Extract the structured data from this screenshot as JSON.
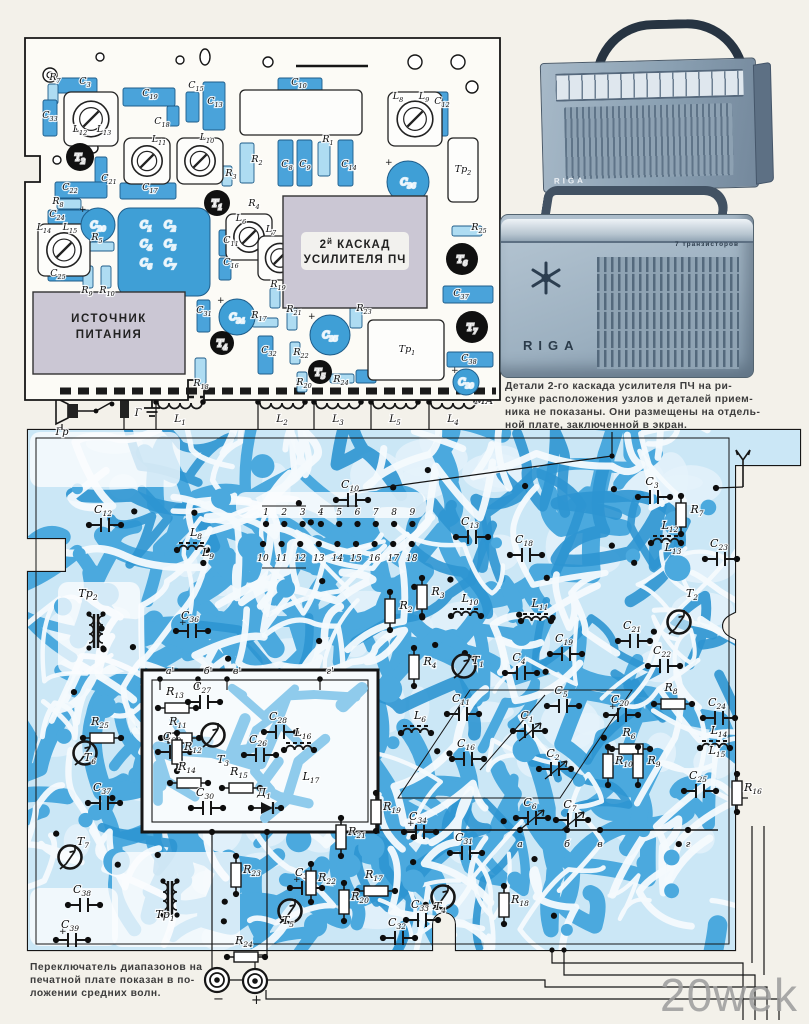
{
  "page": {
    "bg": "#f3f1ea",
    "watermark": "20wek"
  },
  "colors": {
    "trace_mid": "#4ba9de",
    "trace_deep": "#2e95d2",
    "trace_light": "#cbe7f6",
    "channel": "#f4fafd",
    "part_blue": "#4aa3da",
    "part_blue_deep": "#3f9fd6",
    "part_light": "#aedcf2",
    "shield_gray": "#cbc7d4",
    "ink": "#161616"
  },
  "note_right": {
    "lines": [
      "Детали 2-го каскада усилителя ПЧ на ри-",
      "сунке расположения узлов и деталей прием-",
      "ника не показаны. Они размещены на отдель-",
      "ной плате, заключенной в экран."
    ]
  },
  "caption_bottom": {
    "lines": [
      "Переключатель диапазонов на",
      "печатной плате показан в по-",
      "ложении средних волн."
    ]
  },
  "photos": {
    "radio1": {
      "brand": "RIGA"
    },
    "radio2": {
      "brand": "RIGA",
      "subtitle": "7 транзисторов"
    }
  },
  "strip": {
    "speaker": "Гр",
    "jack": "Г",
    "ma": "МА",
    "coils": [
      {
        "l": "L1",
        "x": 180
      },
      {
        "l": "L2",
        "x": 282
      },
      {
        "l": "L3",
        "x": 338
      },
      {
        "l": "L5",
        "x": 395
      },
      {
        "l": "L4",
        "x": 453
      }
    ]
  },
  "connectors": [
    {
      "sign": "−",
      "x": 217,
      "y": 980
    },
    {
      "sign": "+",
      "x": 255,
      "y": 981
    }
  ],
  "comp_board": {
    "shield_if": {
      "pre": "2",
      "sup": "й",
      "post": " КАСКАД",
      "line2": "УСИЛИТЕЛЯ ПЧ",
      "x": 283,
      "y": 196,
      "w": 144,
      "h": 112
    },
    "shield_ps": {
      "line1": "ИСТОЧНИК",
      "line2": "ПИТАНИЯ",
      "x": 33,
      "y": 292,
      "w": 152,
      "h": 82
    },
    "block_caps": {
      "labels": [
        "C1",
        "C2",
        "C4",
        "C5",
        "C6",
        "C7"
      ],
      "x": 118,
      "y": 208,
      "w": 92,
      "h": 88
    },
    "parts": [
      {
        "k": "b",
        "x": 57,
        "y": 78,
        "w": 40,
        "h": 15
      },
      {
        "k": "lb",
        "x": 48,
        "y": 84,
        "w": 10,
        "h": 20
      },
      {
        "k": "b",
        "x": 43,
        "y": 100,
        "w": 14,
        "h": 36
      },
      {
        "k": "b",
        "x": 123,
        "y": 88,
        "w": 52,
        "h": 18
      },
      {
        "k": "b",
        "x": 186,
        "y": 92,
        "w": 13,
        "h": 30
      },
      {
        "k": "b",
        "x": 167,
        "y": 106,
        "w": 12,
        "h": 20
      },
      {
        "k": "b",
        "x": 203,
        "y": 82,
        "w": 22,
        "h": 48
      },
      {
        "k": "b",
        "x": 95,
        "y": 157,
        "w": 12,
        "h": 26
      },
      {
        "k": "b",
        "x": 55,
        "y": 182,
        "w": 52,
        "h": 16
      },
      {
        "k": "lb",
        "x": 57,
        "y": 199,
        "w": 24,
        "h": 10
      },
      {
        "k": "b",
        "x": 48,
        "y": 210,
        "w": 42,
        "h": 14
      },
      {
        "k": "b",
        "x": 48,
        "y": 268,
        "w": 40,
        "h": 13
      },
      {
        "k": "lb",
        "x": 88,
        "y": 242,
        "w": 26,
        "h": 9
      },
      {
        "k": "lb",
        "x": 83,
        "y": 266,
        "w": 10,
        "h": 22
      },
      {
        "k": "lb",
        "x": 101,
        "y": 266,
        "w": 10,
        "h": 22
      },
      {
        "k": "b",
        "x": 120,
        "y": 183,
        "w": 56,
        "h": 16
      },
      {
        "k": "b",
        "x": 197,
        "y": 300,
        "w": 13,
        "h": 32
      },
      {
        "k": "lb",
        "x": 195,
        "y": 358,
        "w": 11,
        "h": 26
      },
      {
        "k": "b",
        "x": 219,
        "y": 230,
        "w": 12,
        "h": 26
      },
      {
        "k": "b",
        "x": 219,
        "y": 258,
        "w": 12,
        "h": 22
      },
      {
        "k": "lb",
        "x": 222,
        "y": 166,
        "w": 10,
        "h": 20
      },
      {
        "k": "lb",
        "x": 240,
        "y": 143,
        "w": 14,
        "h": 40
      },
      {
        "k": "b",
        "x": 278,
        "y": 78,
        "w": 44,
        "h": 16
      },
      {
        "k": "wr",
        "x": 240,
        "y": 90,
        "w": 122,
        "h": 45
      },
      {
        "k": "b",
        "x": 278,
        "y": 140,
        "w": 15,
        "h": 46
      },
      {
        "k": "b",
        "x": 297,
        "y": 140,
        "w": 15,
        "h": 46
      },
      {
        "k": "lb",
        "x": 318,
        "y": 142,
        "w": 12,
        "h": 34
      },
      {
        "k": "b",
        "x": 338,
        "y": 140,
        "w": 15,
        "h": 46
      },
      {
        "k": "b",
        "x": 432,
        "y": 92,
        "w": 16,
        "h": 44
      },
      {
        "k": "wr",
        "x": 448,
        "y": 138,
        "w": 30,
        "h": 64
      },
      {
        "k": "lb",
        "x": 452,
        "y": 226,
        "w": 30,
        "h": 10
      },
      {
        "k": "b",
        "x": 443,
        "y": 286,
        "w": 50,
        "h": 17
      },
      {
        "k": "b",
        "x": 447,
        "y": 352,
        "w": 46,
        "h": 15
      },
      {
        "k": "lb",
        "x": 350,
        "y": 302,
        "w": 12,
        "h": 26
      },
      {
        "k": "lb",
        "x": 287,
        "y": 308,
        "w": 10,
        "h": 22
      },
      {
        "k": "lb",
        "x": 252,
        "y": 318,
        "w": 26,
        "h": 9
      },
      {
        "k": "b",
        "x": 258,
        "y": 336,
        "w": 15,
        "h": 38
      },
      {
        "k": "lb",
        "x": 290,
        "y": 342,
        "w": 10,
        "h": 22
      },
      {
        "k": "lb",
        "x": 297,
        "y": 372,
        "w": 10,
        "h": 20
      },
      {
        "k": "lb",
        "x": 330,
        "y": 374,
        "w": 24,
        "h": 9
      },
      {
        "k": "b",
        "x": 356,
        "y": 370,
        "w": 20,
        "h": 13
      },
      {
        "k": "wr",
        "x": 368,
        "y": 320,
        "w": 76,
        "h": 60
      },
      {
        "k": "lb",
        "x": 270,
        "y": 288,
        "w": 10,
        "h": 20
      }
    ],
    "trimmers": [
      {
        "x": 64,
        "y": 92,
        "s": 54
      },
      {
        "x": 124,
        "y": 138,
        "s": 46
      },
      {
        "x": 177,
        "y": 138,
        "s": 46
      },
      {
        "x": 38,
        "y": 224,
        "s": 52
      },
      {
        "x": 226,
        "y": 214,
        "s": 46
      },
      {
        "x": 258,
        "y": 236,
        "s": 44
      },
      {
        "x": 388,
        "y": 92,
        "s": 54
      }
    ],
    "transistors": [
      {
        "t": "Т1",
        "x": 217,
        "y": 203,
        "r": 13
      },
      {
        "t": "Т2",
        "x": 80,
        "y": 157,
        "r": 14
      },
      {
        "t": "Т4",
        "x": 222,
        "y": 343,
        "r": 12
      },
      {
        "t": "Т5",
        "x": 320,
        "y": 372,
        "r": 12
      },
      {
        "t": "Т6",
        "x": 462,
        "y": 259,
        "r": 16
      },
      {
        "t": "Т7",
        "x": 472,
        "y": 327,
        "r": 16
      }
    ],
    "ecaps": [
      {
        "t": "C20",
        "x": 98,
        "y": 225,
        "r": 17
      },
      {
        "t": "C34",
        "x": 237,
        "y": 317,
        "r": 18
      },
      {
        "t": "C35",
        "x": 330,
        "y": 335,
        "r": 20
      },
      {
        "t": "C36",
        "x": 408,
        "y": 182,
        "r": 21
      },
      {
        "t": "C39",
        "x": 466,
        "y": 382,
        "r": 13
      }
    ],
    "labels": [
      {
        "t": "R7",
        "x": 55,
        "y": 80
      },
      {
        "t": "C3",
        "x": 85,
        "y": 84
      },
      {
        "t": "C33",
        "x": 50,
        "y": 118
      },
      {
        "t": "C19",
        "x": 150,
        "y": 96
      },
      {
        "t": "C15",
        "x": 196,
        "y": 88
      },
      {
        "t": "C18",
        "x": 162,
        "y": 124
      },
      {
        "t": "C13",
        "x": 215,
        "y": 104
      },
      {
        "t": "L12",
        "x": 80,
        "y": 132
      },
      {
        "t": "L13",
        "x": 104,
        "y": 132
      },
      {
        "t": "L11",
        "x": 159,
        "y": 142
      },
      {
        "t": "L10",
        "x": 207,
        "y": 140
      },
      {
        "t": "C21",
        "x": 109,
        "y": 181
      },
      {
        "t": "C22",
        "x": 70,
        "y": 190
      },
      {
        "t": "C17",
        "x": 150,
        "y": 190
      },
      {
        "t": "R8",
        "x": 58,
        "y": 204
      },
      {
        "t": "C24",
        "x": 57,
        "y": 217
      },
      {
        "t": "L14",
        "x": 44,
        "y": 230
      },
      {
        "t": "L15",
        "x": 70,
        "y": 230
      },
      {
        "t": "C25",
        "x": 58,
        "y": 276
      },
      {
        "t": "R5",
        "x": 97,
        "y": 240
      },
      {
        "t": "R9",
        "x": 87,
        "y": 293
      },
      {
        "t": "R10",
        "x": 107,
        "y": 293
      },
      {
        "t": "R2",
        "x": 257,
        "y": 162
      },
      {
        "t": "R3",
        "x": 231,
        "y": 176
      },
      {
        "t": "R4",
        "x": 254,
        "y": 206
      },
      {
        "t": "C11",
        "x": 231,
        "y": 243
      },
      {
        "t": "C16",
        "x": 231,
        "y": 265
      },
      {
        "t": "L6",
        "x": 241,
        "y": 221
      },
      {
        "t": "L7",
        "x": 271,
        "y": 232
      },
      {
        "t": "C31",
        "x": 204,
        "y": 313
      },
      {
        "t": "R18",
        "x": 201,
        "y": 386
      },
      {
        "t": "C10",
        "x": 299,
        "y": 85
      },
      {
        "t": "C8",
        "x": 287,
        "y": 167
      },
      {
        "t": "C9",
        "x": 305,
        "y": 167
      },
      {
        "t": "R1",
        "x": 328,
        "y": 142
      },
      {
        "t": "C14",
        "x": 349,
        "y": 167
      },
      {
        "t": "L8",
        "x": 398,
        "y": 99
      },
      {
        "t": "L9",
        "x": 424,
        "y": 99
      },
      {
        "t": "C12",
        "x": 442,
        "y": 104
      },
      {
        "t": "Тр2",
        "x": 463,
        "y": 172
      },
      {
        "t": "R25",
        "x": 479,
        "y": 230
      },
      {
        "t": "C37",
        "x": 461,
        "y": 296
      },
      {
        "t": "C38",
        "x": 469,
        "y": 361
      },
      {
        "t": "R23",
        "x": 364,
        "y": 311
      },
      {
        "t": "R21",
        "x": 294,
        "y": 312
      },
      {
        "t": "R17",
        "x": 259,
        "y": 318
      },
      {
        "t": "C32",
        "x": 269,
        "y": 353
      },
      {
        "t": "R22",
        "x": 301,
        "y": 355
      },
      {
        "t": "R19",
        "x": 278,
        "y": 287
      },
      {
        "t": "R20",
        "x": 304,
        "y": 385
      },
      {
        "t": "R24",
        "x": 341,
        "y": 382
      },
      {
        "t": "Тр1",
        "x": 407,
        "y": 352
      }
    ]
  },
  "pcb": {
    "pins_top": [
      "1",
      "2",
      "3",
      "4",
      "5",
      "6",
      "7",
      "8",
      "9"
    ],
    "pins_bottom": [
      "10",
      "11",
      "12",
      "13",
      "14",
      "15",
      "16",
      "17",
      "18"
    ],
    "corner_letters": [
      {
        "t": "а",
        "x": 520
      },
      {
        "t": "б",
        "x": 567
      },
      {
        "t": "в",
        "x": 600
      },
      {
        "t": "г",
        "x": 688
      }
    ],
    "sub_corners": [
      {
        "t": "а'",
        "x": 170
      },
      {
        "t": "б'",
        "x": 208
      },
      {
        "t": "в'",
        "x": 237
      },
      {
        "t": "г'",
        "x": 330
      }
    ],
    "labels": [
      {
        "t": "C10",
        "x": 350,
        "y": 488,
        "k": "c"
      },
      {
        "t": "C13",
        "x": 470,
        "y": 525,
        "k": "c"
      },
      {
        "t": "C18",
        "x": 524,
        "y": 543,
        "k": "c"
      },
      {
        "t": "C12",
        "x": 103,
        "y": 513,
        "k": "c"
      },
      {
        "t": "L8",
        "x": 196,
        "y": 536,
        "k": "l"
      },
      {
        "t": "L9",
        "x": 208,
        "y": 556,
        "k": "p"
      },
      {
        "t": "C3",
        "x": 652,
        "y": 485,
        "k": "c"
      },
      {
        "t": "R7",
        "x": 697,
        "y": 513,
        "k": "rv"
      },
      {
        "t": "C23",
        "x": 719,
        "y": 547,
        "k": "c"
      },
      {
        "t": "L12",
        "x": 670,
        "y": 529,
        "k": "l"
      },
      {
        "t": "L13",
        "x": 673,
        "y": 551,
        "k": "p"
      },
      {
        "t": "Тр2",
        "x": 88,
        "y": 597,
        "k": "f",
        "dx": 8,
        "dy": 34
      },
      {
        "t": "C36",
        "x": 190,
        "y": 619,
        "k": "e"
      },
      {
        "t": "Т2",
        "x": 692,
        "y": 597,
        "k": "t",
        "dx": -13,
        "dy": 25
      },
      {
        "t": "R2",
        "x": 406,
        "y": 609,
        "k": "rv"
      },
      {
        "t": "R3",
        "x": 438,
        "y": 595,
        "k": "rv"
      },
      {
        "t": "L10",
        "x": 470,
        "y": 602,
        "k": "l"
      },
      {
        "t": "L11",
        "x": 540,
        "y": 607,
        "k": "l"
      },
      {
        "t": "C19",
        "x": 564,
        "y": 642,
        "k": "c"
      },
      {
        "t": "C21",
        "x": 632,
        "y": 629,
        "k": "c"
      },
      {
        "t": "C22",
        "x": 662,
        "y": 654,
        "k": "c"
      },
      {
        "t": "R4",
        "x": 430,
        "y": 665,
        "k": "rv"
      },
      {
        "t": "Т1",
        "x": 478,
        "y": 664,
        "k": "t",
        "dx": -14,
        "dy": 2
      },
      {
        "t": "C4",
        "x": 519,
        "y": 661,
        "k": "c"
      },
      {
        "t": "C5",
        "x": 561,
        "y": 694,
        "k": "c"
      },
      {
        "t": "C11",
        "x": 461,
        "y": 702,
        "k": "c"
      },
      {
        "t": "R8",
        "x": 671,
        "y": 691,
        "k": "r"
      },
      {
        "t": "C20",
        "x": 620,
        "y": 703,
        "k": "e"
      },
      {
        "t": "C24",
        "x": 717,
        "y": 706,
        "k": "c"
      },
      {
        "t": "L6",
        "x": 420,
        "y": 719,
        "k": "l"
      },
      {
        "t": "C1",
        "x": 527,
        "y": 719,
        "k": "v"
      },
      {
        "t": "R6",
        "x": 629,
        "y": 736,
        "k": "r"
      },
      {
        "t": "L14",
        "x": 719,
        "y": 734,
        "k": "l"
      },
      {
        "t": "L15",
        "x": 717,
        "y": 754,
        "k": "p"
      },
      {
        "t": "C16",
        "x": 466,
        "y": 747,
        "k": "c"
      },
      {
        "t": "C2",
        "x": 553,
        "y": 757,
        "k": "v"
      },
      {
        "t": "R10",
        "x": 624,
        "y": 764,
        "k": "rv"
      },
      {
        "t": "R9",
        "x": 654,
        "y": 764,
        "k": "rv"
      },
      {
        "t": "C25",
        "x": 698,
        "y": 779,
        "k": "c"
      },
      {
        "t": "R16",
        "x": 753,
        "y": 791,
        "k": "rv"
      },
      {
        "t": "C6",
        "x": 530,
        "y": 806,
        "k": "v"
      },
      {
        "t": "C7",
        "x": 570,
        "y": 808,
        "k": "v"
      },
      {
        "t": "R25",
        "x": 100,
        "y": 725,
        "k": "r"
      },
      {
        "t": "Т6",
        "x": 90,
        "y": 761,
        "k": "t",
        "dx": -5,
        "dy": -8
      },
      {
        "t": "C37",
        "x": 102,
        "y": 791,
        "k": "c"
      },
      {
        "t": "Т7",
        "x": 83,
        "y": 845,
        "k": "t",
        "dx": -13,
        "dy": 12
      },
      {
        "t": "C38",
        "x": 82,
        "y": 893,
        "k": "c"
      },
      {
        "t": "C39",
        "x": 70,
        "y": 928,
        "k": "e"
      },
      {
        "t": "Тр1",
        "x": 165,
        "y": 918,
        "k": "f",
        "dx": 5,
        "dy": -20
      },
      {
        "t": "R23",
        "x": 252,
        "y": 873,
        "k": "rv"
      },
      {
        "t": "C35",
        "x": 304,
        "y": 876,
        "k": "e"
      },
      {
        "t": "Т5",
        "x": 288,
        "y": 924,
        "k": "t",
        "dx": 2,
        "dy": -13
      },
      {
        "t": "R24",
        "x": 244,
        "y": 944,
        "k": "r"
      },
      {
        "t": "R19",
        "x": 392,
        "y": 810,
        "k": "rv"
      },
      {
        "t": "R21",
        "x": 357,
        "y": 835,
        "k": "rv"
      },
      {
        "t": "C34",
        "x": 418,
        "y": 820,
        "k": "e"
      },
      {
        "t": "C31",
        "x": 464,
        "y": 841,
        "k": "c"
      },
      {
        "t": "R17",
        "x": 374,
        "y": 878,
        "k": "r"
      },
      {
        "t": "R22",
        "x": 327,
        "y": 881,
        "k": "rv"
      },
      {
        "t": "R20",
        "x": 360,
        "y": 900,
        "k": "rv"
      },
      {
        "t": "C33",
        "x": 420,
        "y": 908,
        "k": "c"
      },
      {
        "t": "Т4",
        "x": 440,
        "y": 910,
        "k": "t",
        "dx": 3,
        "dy": -13
      },
      {
        "t": "R18",
        "x": 520,
        "y": 903,
        "k": "rv"
      },
      {
        "t": "C32",
        "x": 397,
        "y": 926,
        "k": "c"
      },
      {
        "t": "R13",
        "x": 175,
        "y": 695,
        "k": "r"
      },
      {
        "t": "C27",
        "x": 202,
        "y": 690,
        "k": "c"
      },
      {
        "t": "R11",
        "x": 178,
        "y": 725,
        "k": "r"
      },
      {
        "t": "C29",
        "x": 172,
        "y": 740,
        "k": "c"
      },
      {
        "t": "R12",
        "x": 193,
        "y": 750,
        "k": "rv"
      },
      {
        "t": "Т3",
        "x": 223,
        "y": 763,
        "k": "t",
        "dx": -10,
        "dy": -28
      },
      {
        "t": "C26",
        "x": 258,
        "y": 743,
        "k": "c"
      },
      {
        "t": "C28",
        "x": 278,
        "y": 720,
        "k": "c"
      },
      {
        "t": "L16",
        "x": 303,
        "y": 736,
        "k": "l"
      },
      {
        "t": "L17",
        "x": 311,
        "y": 780,
        "k": "p"
      },
      {
        "t": "R14",
        "x": 187,
        "y": 770,
        "k": "r"
      },
      {
        "t": "C30",
        "x": 205,
        "y": 796,
        "k": "c"
      },
      {
        "t": "R15",
        "x": 239,
        "y": 775,
        "k": "r"
      },
      {
        "t": "Д1",
        "x": 264,
        "y": 796,
        "k": "d"
      }
    ]
  }
}
